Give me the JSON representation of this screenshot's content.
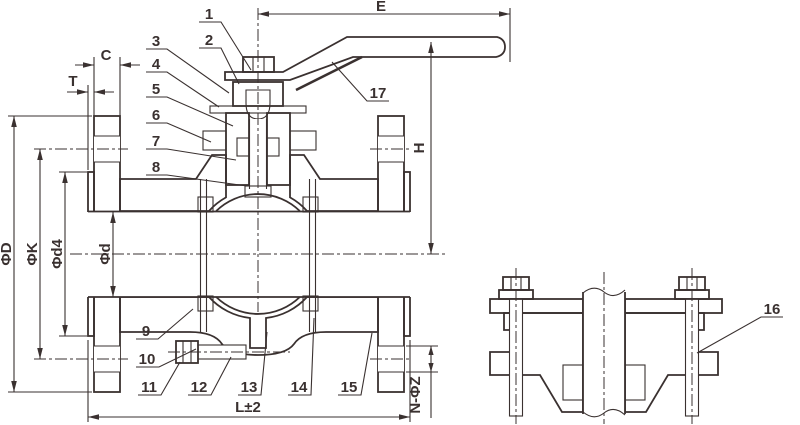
{
  "drawing": {
    "callouts": {
      "1": "1",
      "2": "2",
      "3": "3",
      "4": "4",
      "5": "5",
      "6": "6",
      "7": "7",
      "8": "8",
      "9": "9",
      "10": "10",
      "11": "11",
      "12": "12",
      "13": "13",
      "14": "14",
      "15": "15",
      "16": "16",
      "17": "17"
    },
    "dims": {
      "E": "E",
      "H": "H",
      "C": "C",
      "T": "T",
      "phiD": "ΦD",
      "phiK": "ΦK",
      "phid4": "Φd4",
      "phid": "Φd",
      "L": "L±2",
      "NZ": "N-ΦZ"
    },
    "colors": {
      "line": "#3a3130",
      "background": "#ffffff"
    }
  }
}
